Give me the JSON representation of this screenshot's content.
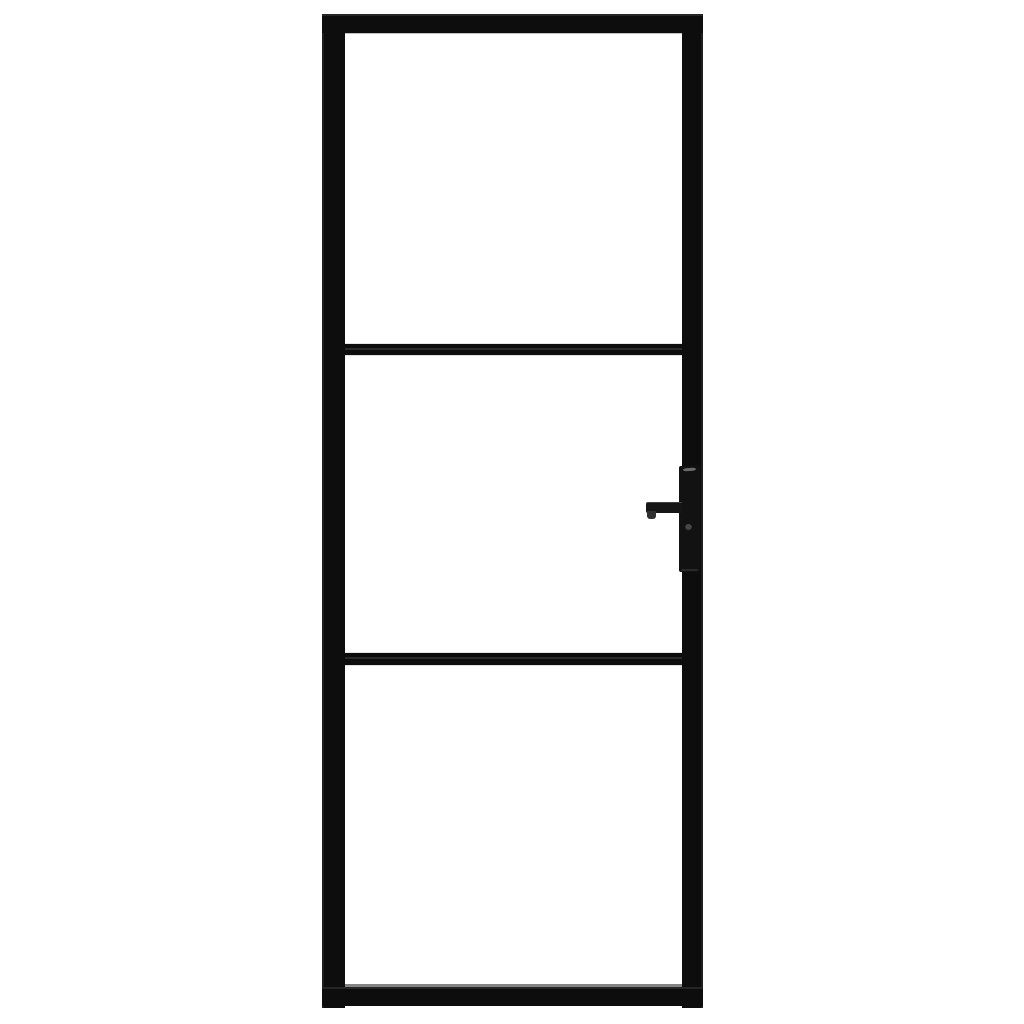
{
  "image": {
    "type": "product-photo",
    "subject": "Black interior door with metal frame and three clear glass panels, lever handle on right side",
    "door": {
      "panel_count": 3,
      "muntin_bar_count": 2,
      "handle_side": "right",
      "handle_parts": [
        "backplate",
        "lever",
        "keyhole"
      ]
    }
  },
  "colors": {
    "background": "#ffffff",
    "frame": "#0d0d0d",
    "glass": "#ffffff",
    "glass_edge_shadow": "#8d8d8d",
    "bottom_reflection": "#6e6e6e",
    "handle_backplate": "#121212",
    "handle_lever": "#161616",
    "handle_lever_end": "#303030",
    "handle_highlight": "#7a7a7a",
    "keyhole": "#474747"
  }
}
